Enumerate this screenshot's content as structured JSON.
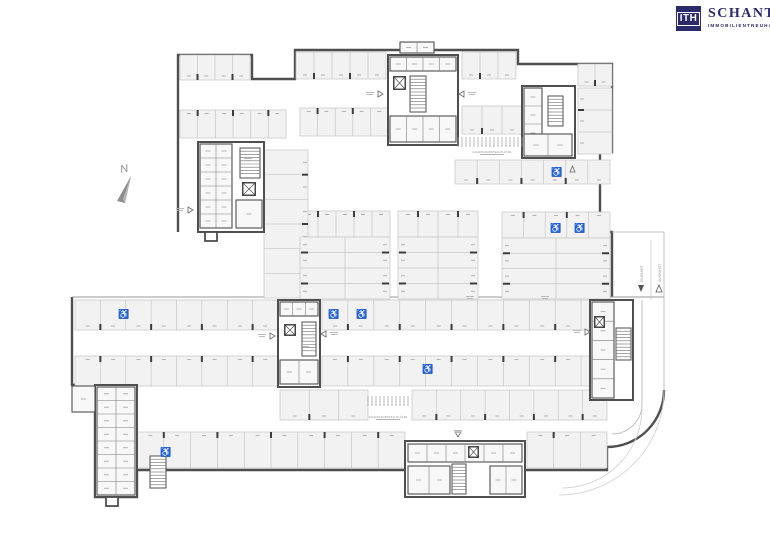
{
  "brand": {
    "monogram": "ITH",
    "name": "SCHANTL",
    "tagline": "IMMOBILIENTREUHAND",
    "navy": "#2b2a6b"
  },
  "compass": {
    "north": "N"
  },
  "ramp": {
    "in": "EINFAHRT",
    "out": "AUSFAHRT"
  },
  "labels": {
    "bikes": "FAHRRADABSTELLPLÄTZE"
  },
  "icons": {
    "accessible": "♿"
  },
  "colors": {
    "wall": "#4f4f4f",
    "thin": "#c6c6c6",
    "mid": "#9a9a9a",
    "stallFill": "#f2f2f2",
    "roomFill": "#f8f8f8",
    "tick": "#3d3d3d",
    "dash": "#b3b3b3",
    "faint": "#cfcfcf",
    "gray": "#8e8e8e"
  }
}
